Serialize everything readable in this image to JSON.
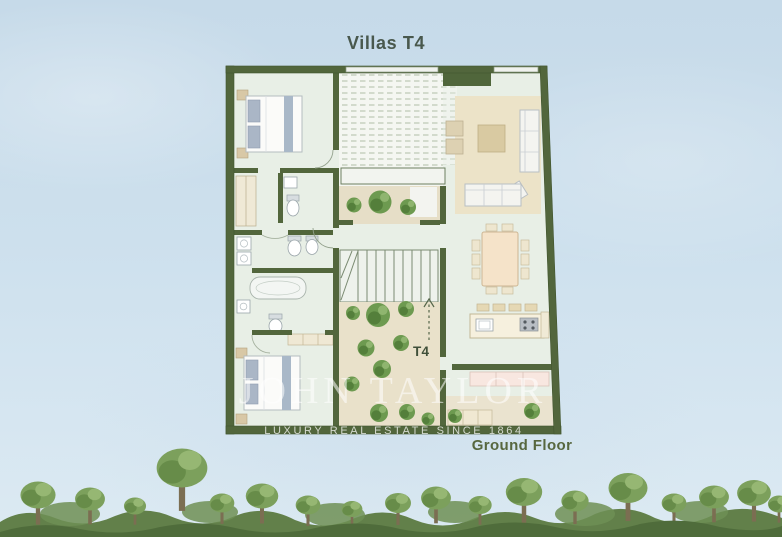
{
  "title": "Villas T4",
  "plan": {
    "unit_label": "T4",
    "floor_label": "Ground Floor"
  },
  "watermark": {
    "brand": "JOHN TAYLOR",
    "tagline": "LUXURY REAL ESTATE SINCE 1864"
  },
  "colors": {
    "sky": "#cde0ed",
    "wall_green": "#52663c",
    "floor_mint": "#e8efe6",
    "deck_white": "#f4f6f1",
    "courtyard_beige": "#e8e0c9",
    "rug_beige": "#ece3c8",
    "tree_green": "#6d9a50",
    "forest_green": "#62804a",
    "label_green": "#49584d",
    "floor_label_green": "#57673f",
    "watermark_white": "rgba(255,255,255,0.55)"
  }
}
